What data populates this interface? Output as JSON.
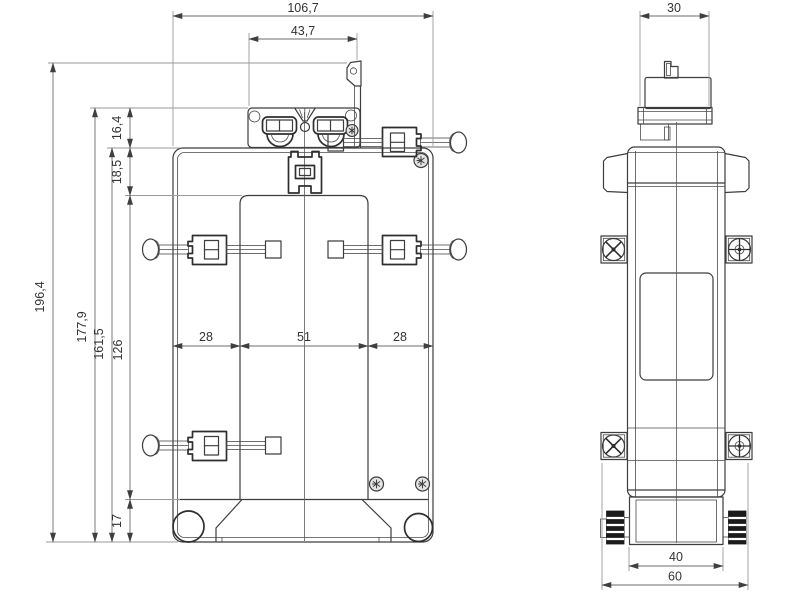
{
  "drawing": {
    "type": "technical-dimension-drawing",
    "views": 2,
    "decimal_style": "comma",
    "colors": {
      "background": "#ffffff",
      "geometry_line": "#3d3d3d",
      "dimension_line": "#6b6b6b",
      "extension_line": "#9a9a9a",
      "text": "#333333",
      "knob_fill": "#1b1b1b"
    },
    "front_view": {
      "dims": {
        "overall_width": "106,7",
        "terminal_width": "43,7",
        "total_height": "196,4",
        "height_terminal_top": "177,9",
        "case_height": "161,5",
        "window_height": "126",
        "terminal_height": "16,4",
        "case_top_to_window": "18,5",
        "base_height": "17",
        "left_section": "28",
        "window_width": "51",
        "right_section": "28"
      }
    },
    "side_view": {
      "dims": {
        "top_width": "30",
        "body_width": "40",
        "overall_width": "60"
      }
    }
  }
}
